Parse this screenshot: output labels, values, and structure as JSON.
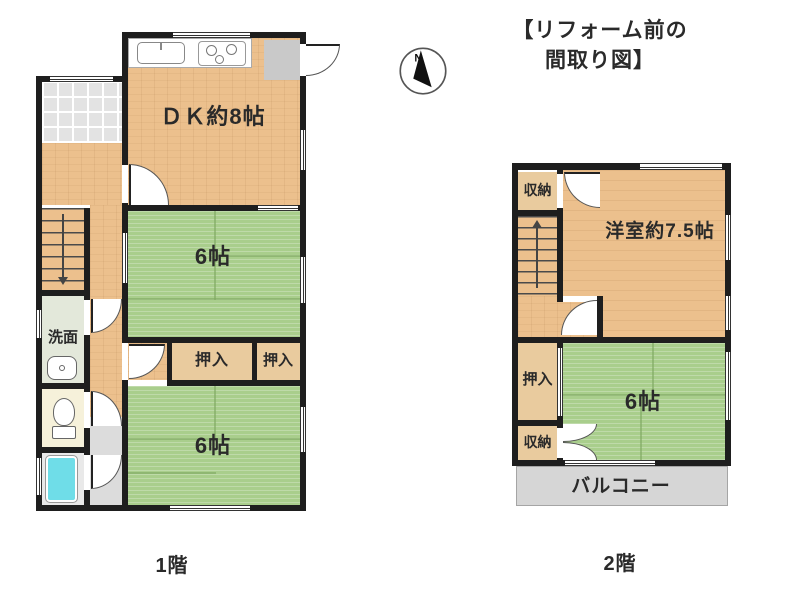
{
  "title": {
    "line1": "【リフォーム前の",
    "line2": "間取り図】"
  },
  "compass": {
    "label": "N"
  },
  "floor1": {
    "caption": "1階",
    "rooms": {
      "dk": "ＤＫ約8帖",
      "tatami_upper": "6帖",
      "closet_left": "押入",
      "closet_right": "押入",
      "washroom": "洗面",
      "tatami_lower": "6帖"
    }
  },
  "floor2": {
    "caption": "2階",
    "rooms": {
      "storage_top": "収納",
      "western": "洋室約7.5帖",
      "closet": "押入",
      "storage_bottom": "収納",
      "tatami": "6帖",
      "balcony": "バルコニー"
    }
  },
  "colors": {
    "wall": "#1e1e1e",
    "wood": "#ecc08d",
    "tatami": "#a9ce8c",
    "tatamiline": "#7fa861",
    "closet": "#e9cb9e",
    "genkan": "#e3e3e3",
    "balcony": "#d6d6d6",
    "washroom": "#e3e8da",
    "toiletfloor": "#f6f1da",
    "bathfloor": "#e9e9e9",
    "tub": "#6fdde8",
    "text": "#2a2a2a"
  }
}
